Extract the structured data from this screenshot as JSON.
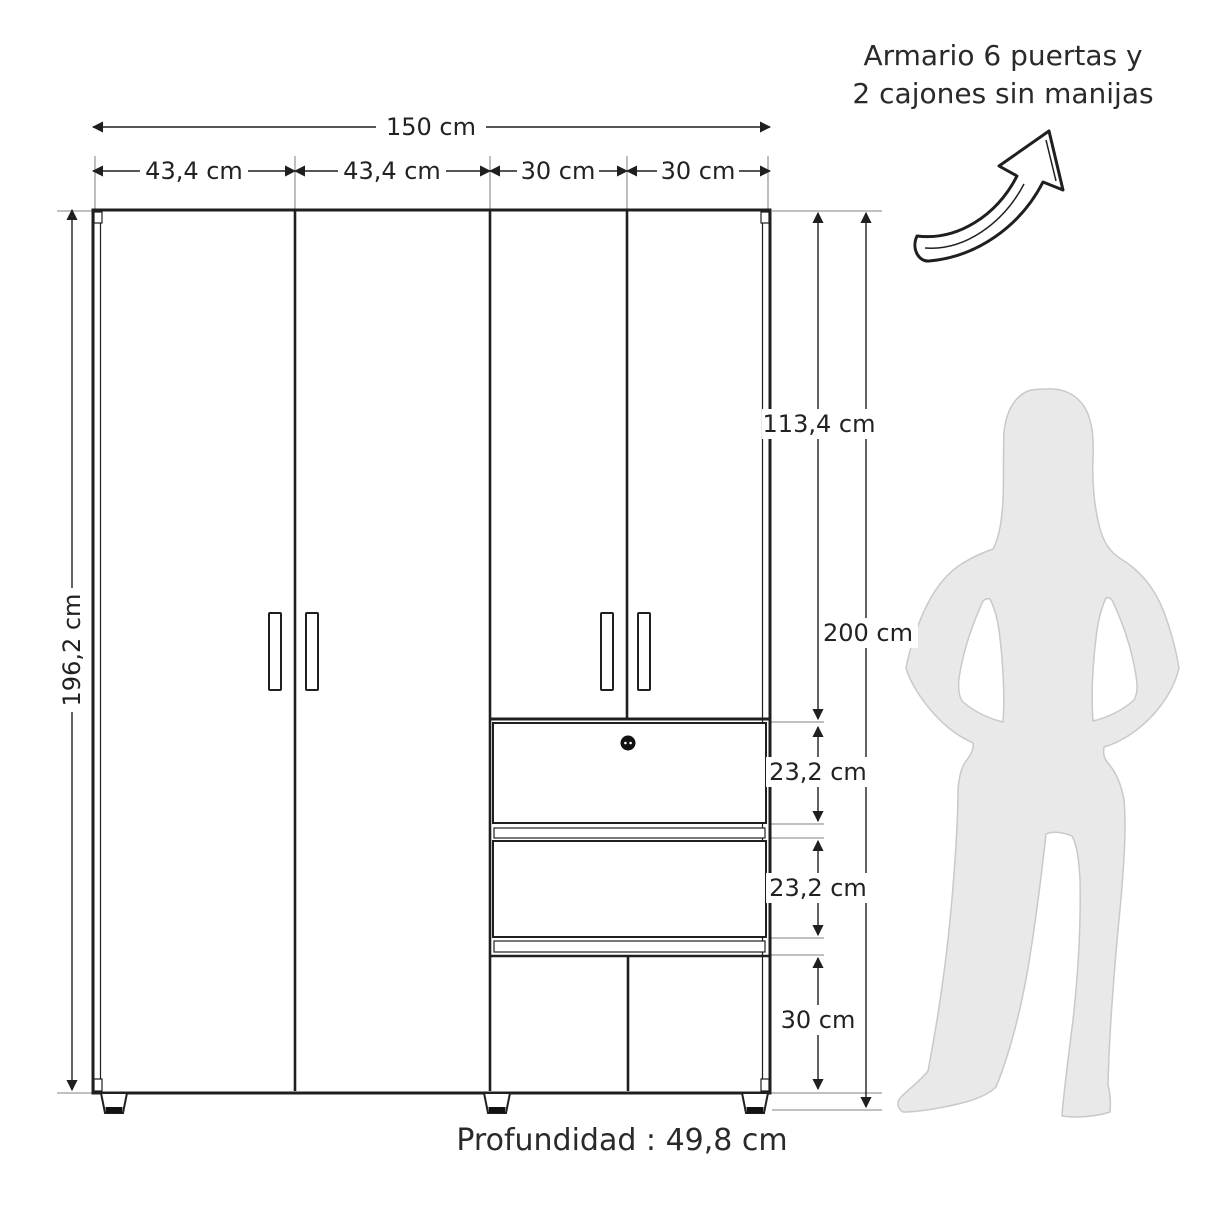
{
  "title": {
    "line1": "Armario 6 puertas y",
    "line2": "2 cajones sin manijas"
  },
  "cabinet": {
    "dimensions": {
      "total_width": "150 cm",
      "door_widths": [
        "43,4 cm",
        "43,4 cm",
        "30 cm",
        "30 cm"
      ],
      "body_height": "196,2 cm",
      "top_doors_height": "113,4 cm",
      "total_height": "200 cm",
      "drawer_height_1": "23,2 cm",
      "drawer_height_2": "23,2 cm",
      "bottom_doors_height": "30 cm"
    },
    "depth_label": "Profundidad : 49,8 cm"
  },
  "icons": {
    "arrow": "hand-drawn-curved-arrow",
    "lock": "keyhole-lock",
    "silhouette": "woman-scale-figure"
  },
  "colors": {
    "line": "#1f1f1f",
    "extension_line": "#9b9b9b",
    "silhouette_fill": "#e9e9e9",
    "silhouette_stroke": "#c9c9c9",
    "background": "#ffffff"
  }
}
